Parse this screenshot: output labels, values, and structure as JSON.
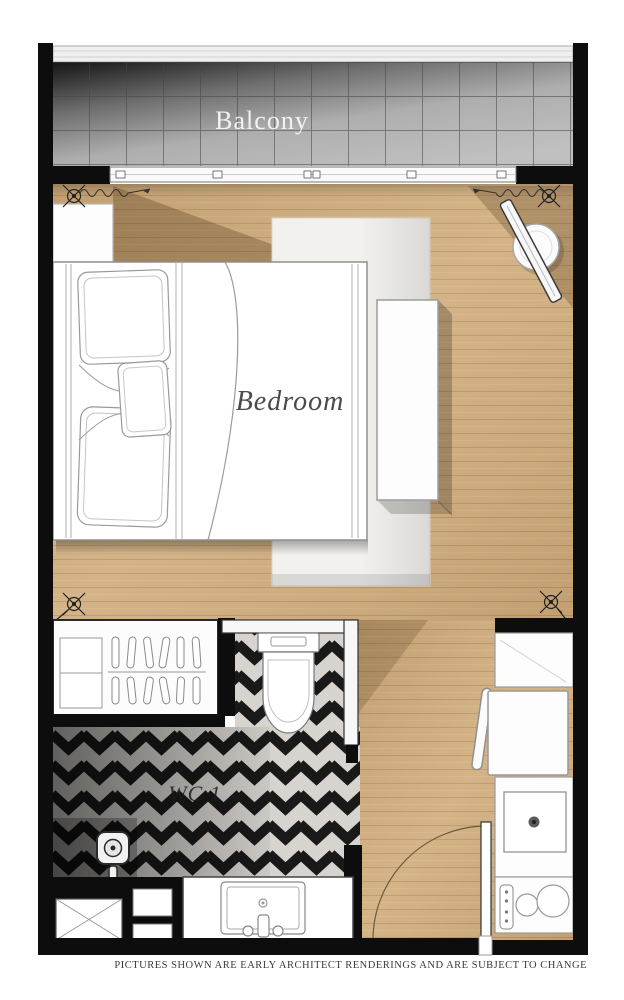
{
  "labels": {
    "balcony": "Balcony",
    "bedroom": "Bedroom",
    "wc": "WC 1"
  },
  "disclaimer": "PICTURES SHOWN ARE EARLY ARCHITECT RENDERINGS AND ARE SUBJECT TO CHANGE",
  "rooms": [
    "Balcony",
    "Bedroom",
    "WC 1"
  ],
  "icons": [
    "sliding-door",
    "curtain-track",
    "keynote-marker",
    "nightstand",
    "double-bed",
    "pillow",
    "rug",
    "console-table",
    "stool",
    "floor-mirror",
    "wardrobe",
    "clothes-hanger",
    "toilet",
    "shower-drain",
    "vanity-sink",
    "faucet",
    "shaft-cross",
    "refrigerator",
    "chair",
    "dining-table",
    "kitchen-sink",
    "cooktop",
    "entrance-door",
    "door-swing-arc",
    "balcony-tiles",
    "wood-floor"
  ],
  "colors": {
    "wall": "#0d0d0d",
    "wood_floor": "#cfad7f",
    "balcony_tile": "#b9b9b9",
    "chevron_dark": "#191919",
    "chevron_light": "#d7d4cf",
    "rug": "#f2f1ee",
    "furniture_outline": "#9a9a9a",
    "label_dark": "#4a4a4a",
    "label_light": "#f2f2f2"
  }
}
